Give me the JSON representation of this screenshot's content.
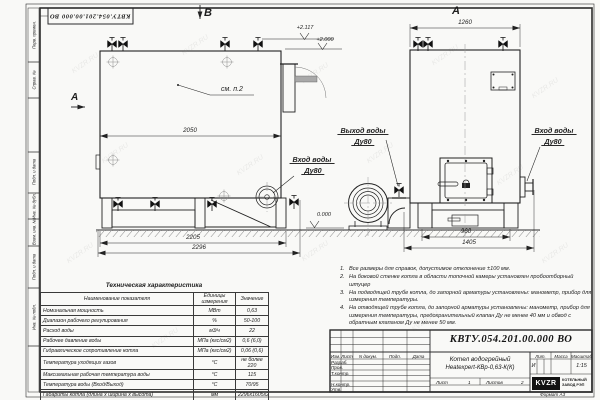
{
  "frame": {
    "doc_number_top": "КВТУ.054.201.00.000 ВО",
    "format_label": "Формат А3",
    "watermark": "KVZR.RU",
    "left_strip": {
      "s1": "Перв. примен.",
      "s2": "Справ. №",
      "s3": "Подп. и дата",
      "s4": "Инв. № дубл.",
      "s5": "Взам. инв. №",
      "s6": "Подп. и дата",
      "s7": "Инв. № подл."
    }
  },
  "drawing": {
    "view_b_label": "В",
    "view_a_label": "А",
    "section_label": "А",
    "see_note": "см. п.2",
    "elev_top1": "+2.117",
    "elev_top2": "+2.000",
    "elev_zero": "0.000",
    "dim_b_width": "2050",
    "dim_b_base": "2205",
    "dim_b_overall": "2296",
    "dim_a_width": "1260",
    "dim_a_base": "960",
    "dim_a_overall": "1405",
    "label_out": "Выход воды",
    "label_out_dn": "Ду80",
    "label_in_b": "Вход воды",
    "label_in_b_dn": "Ду80",
    "label_in_a": "Вход воды",
    "label_in_a_dn": "Ду80"
  },
  "tech_table": {
    "title": "Техническая характеристика",
    "col_name": "Наименование показателя",
    "col_unit": "Единицы измерения",
    "col_value": "Значение",
    "rows": [
      {
        "name": "Номинальная мощность",
        "unit": "МВт",
        "value": "0,63"
      },
      {
        "name": "Диапазон рабочего регулирования",
        "unit": "%",
        "value": "50-100"
      },
      {
        "name": "Расход воды",
        "unit": "м3/ч",
        "value": "22"
      },
      {
        "name": "Рабочее давление воды",
        "unit": "МПа (кгс/см2)",
        "value": "0,6 (6,0)"
      },
      {
        "name": "Гидравлическое сопротивление котла",
        "unit": "МПа (кгс/см2)",
        "value": "0,06 (0,6)"
      },
      {
        "name": "Температура уходящих газов",
        "unit": "°С",
        "value": "не более 220"
      },
      {
        "name": "Максимальная рабочая температура воды",
        "unit": "°С",
        "value": "115"
      },
      {
        "name": "Температура воды (Вход/Выход)",
        "unit": "°С",
        "value": "70/95"
      },
      {
        "name": "Габариты котла (длина х ширина х высота)",
        "unit": "мм",
        "value": "2296х1605х2117"
      }
    ]
  },
  "notes": [
    {
      "n": "1.",
      "text": "Все размеры для справок, допустимое отклонение ±100 мм."
    },
    {
      "n": "2.",
      "text": "На боковой стенке котла в области топочной камеры установлен пробоотборный штуцер"
    },
    {
      "n": "3.",
      "text": "На подводящей трубе котла, до запорной арматуры установлены: манометр, прибор для измерения температуры."
    },
    {
      "n": "4.",
      "text": "На отводящей трубе котла, до запорной арматуры установлены: манометр, прибор для измерения температуры, предохранительный клапан Ду не менее 40 мм и обвод с обратным клапаном Ду не менее 50 мм."
    }
  ],
  "title_block": {
    "doc_number": "КВТУ.054.201.00.000 ВО",
    "name_line1": "Котел водогрейный",
    "name_line2": "Heatexpert-КВр-0,63-К(К)",
    "h_izm": "Изм.",
    "h_list": "Лист",
    "h_doc": "N докум.",
    "h_podp": "Подп.",
    "h_data": "Дата",
    "r1": "Разраб.",
    "r2": "Пров.",
    "r3": "Т.контр.",
    "r5": "Н.контр.",
    "r6": "Утв.",
    "lit": "Лит.",
    "massa": "Масса",
    "masshtab": "Масштаб",
    "lit_value": "И",
    "scale_value": "1:15",
    "sheet_label": "Лист",
    "sheet_value": "1",
    "sheets_label": "Листов",
    "sheets_value": "2",
    "logo_text": "KVZR",
    "logo_caption1": "КОТЕЛЬНЫЙ",
    "logo_caption2": "ЗАВОД РЭП"
  }
}
